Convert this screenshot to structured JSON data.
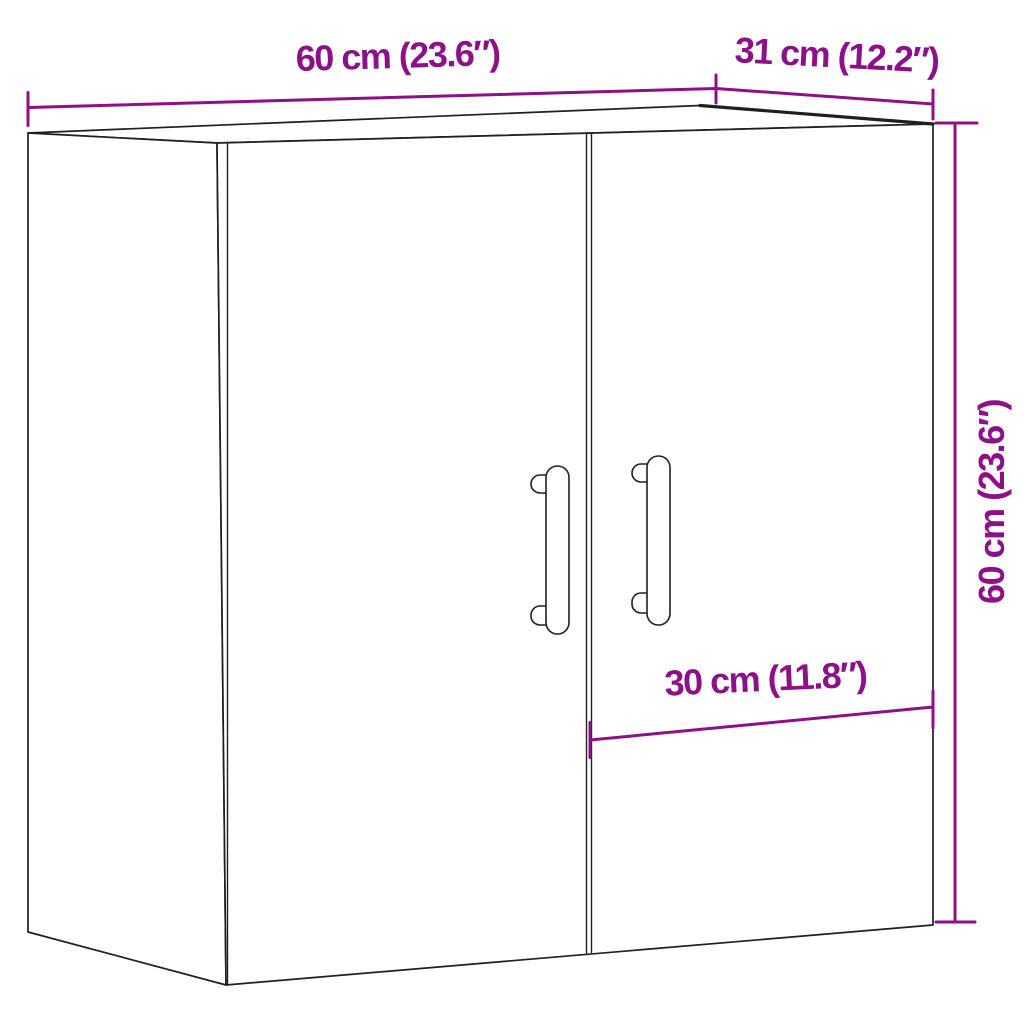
{
  "diagram": {
    "background_color": "#ffffff",
    "outline_color": "#1f1f1f",
    "dimension_color": "#8D1089",
    "dimensions": {
      "width": {
        "label": "60 cm (23.6″)",
        "cm": "60",
        "inches": "23.6"
      },
      "depth": {
        "label": "31 cm (12.2″)",
        "cm": "31",
        "inches": "12.2"
      },
      "height": {
        "label": "60 cm (23.6″)",
        "cm": "60",
        "inches": "23.6"
      },
      "door_width": {
        "label": "30 cm (11.8″)",
        "cm": "30",
        "inches": "11.8"
      }
    }
  }
}
